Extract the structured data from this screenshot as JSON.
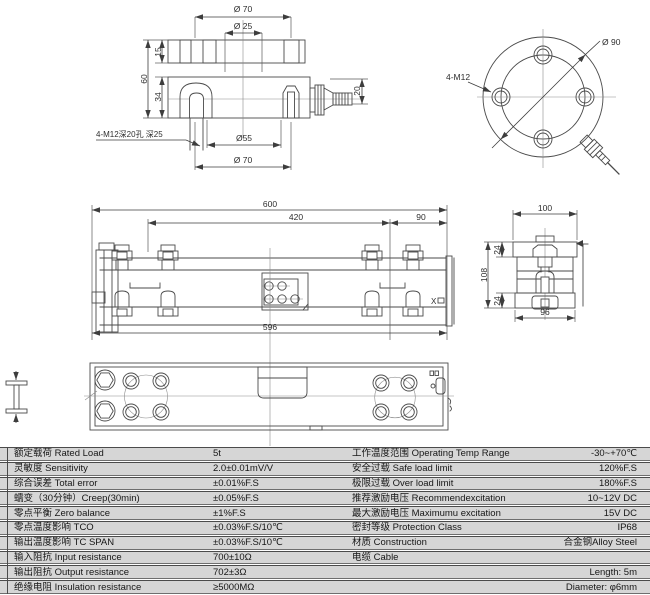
{
  "colors": {
    "line": "#4a4a4a",
    "row_background": "#d6d6d6",
    "text": "#171717"
  },
  "drawings": {
    "section": {
      "dia70_top": "Ø 70",
      "dia25": "Ø 25",
      "dim15": "15",
      "dim60": "60",
      "dim34": "34",
      "dim20": "20",
      "dia55": "Ø55",
      "dia70_bottom": "Ø 70",
      "holes_note": "4-M12深20孔 深25"
    },
    "top": {
      "dia90": "Ø 90",
      "bolts": "4-M12"
    },
    "side": {
      "dim600": "600",
      "dim420": "420",
      "dim90": "90",
      "dim596": "596",
      "x_label": "X"
    },
    "end": {
      "dim100": "100",
      "dim24_top": "24",
      "dim108": "108",
      "dim24_bottom": "24",
      "dim96": "96"
    }
  },
  "specs": {
    "rows": [
      {
        "left_label": "额定载荷 Rated Load",
        "left_value": "5t",
        "right_label": "工作温度范围 Operating Temp Range",
        "right_value": "-30~+70℃"
      },
      {
        "left_label": "灵敏度 Sensitivity",
        "left_value": "2.0±0.01mV/V",
        "right_label": "安全过载 Safe load limit",
        "right_value": "120%F.S"
      },
      {
        "left_label": "综合误差 Total error",
        "left_value": "±0.01%F.S",
        "right_label": "极限过载 Over load limit",
        "right_value": "180%F.S"
      },
      {
        "left_label": "蠕变（30分钟）Creep(30min)",
        "left_value": "±0.05%F.S",
        "right_label": "推荐激励电压 Recommendexcitation",
        "right_value": "10~12V DC"
      },
      {
        "left_label": "零点平衡 Zero balance",
        "left_value": "±1%F.S",
        "right_label": "最大激励电压 Maximumu excitation",
        "right_value": "15V DC"
      },
      {
        "left_label": "零点温度影响 TCO",
        "left_value": "±0.03%F.S/10℃",
        "right_label": "密封等级 Protection Class",
        "right_value": "IP68"
      },
      {
        "left_label": "输出温度影响 TC SPAN",
        "left_value": "±0.03%F.S/10℃",
        "right_label": "材质 Construction",
        "right_value": "合金钢Alloy Steel"
      },
      {
        "left_label": "输入阻抗 Input resistance",
        "left_value": "700±10Ω",
        "right_label": "电缆 Cable",
        "right_value": ""
      },
      {
        "left_label": "输出阻抗 Output resistance",
        "left_value": "702±3Ω",
        "right_label": "",
        "right_value": "Length: 5m"
      },
      {
        "left_label": "绝缘电阻 Insulation resistance",
        "left_value": "≥5000MΩ",
        "right_label": "",
        "right_value": "Diameter: φ6mm"
      }
    ]
  }
}
